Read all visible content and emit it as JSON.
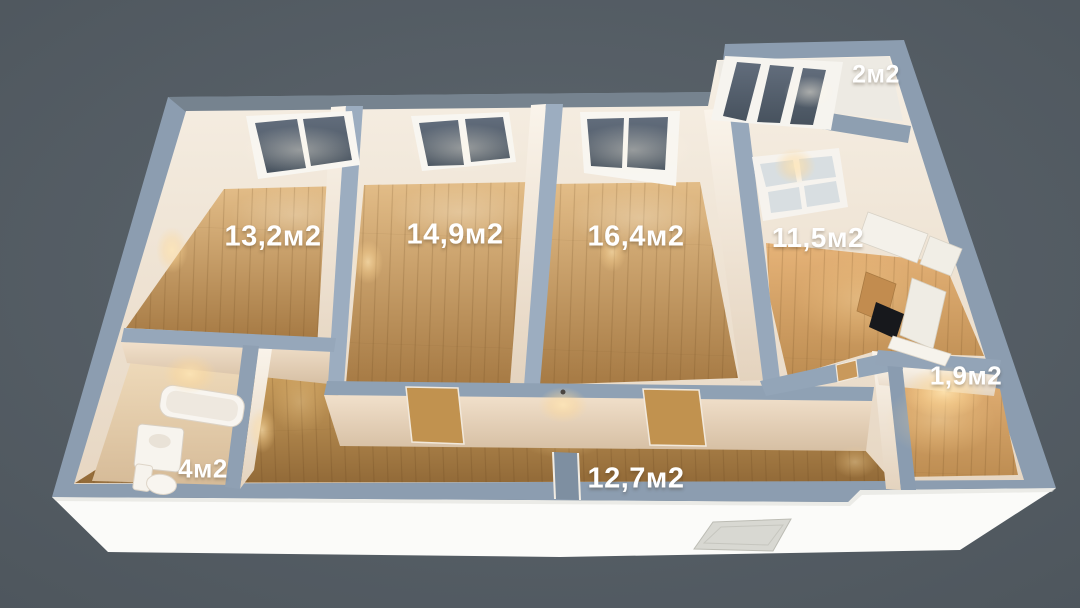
{
  "rooms": [
    {
      "id": "bedroom-1",
      "area_label": "13,2м2"
    },
    {
      "id": "bedroom-2",
      "area_label": "14,9м2"
    },
    {
      "id": "living-room",
      "area_label": "16,4м2"
    },
    {
      "id": "kitchen",
      "area_label": "11,5м2"
    },
    {
      "id": "balcony",
      "area_label": "2м2"
    },
    {
      "id": "storage",
      "area_label": "1,9м2"
    },
    {
      "id": "bathroom",
      "area_label": "4м2"
    },
    {
      "id": "hallway",
      "area_label": "12,7м2"
    }
  ],
  "colors": {
    "background": "#57616a",
    "wall_top": "#94a5b8",
    "wall_face": "#f3e9da",
    "floor_wood": "#c2945c",
    "window_glass": "#5a6573",
    "base_slab": "#fbfbf9",
    "label_text": "#ffffff"
  }
}
